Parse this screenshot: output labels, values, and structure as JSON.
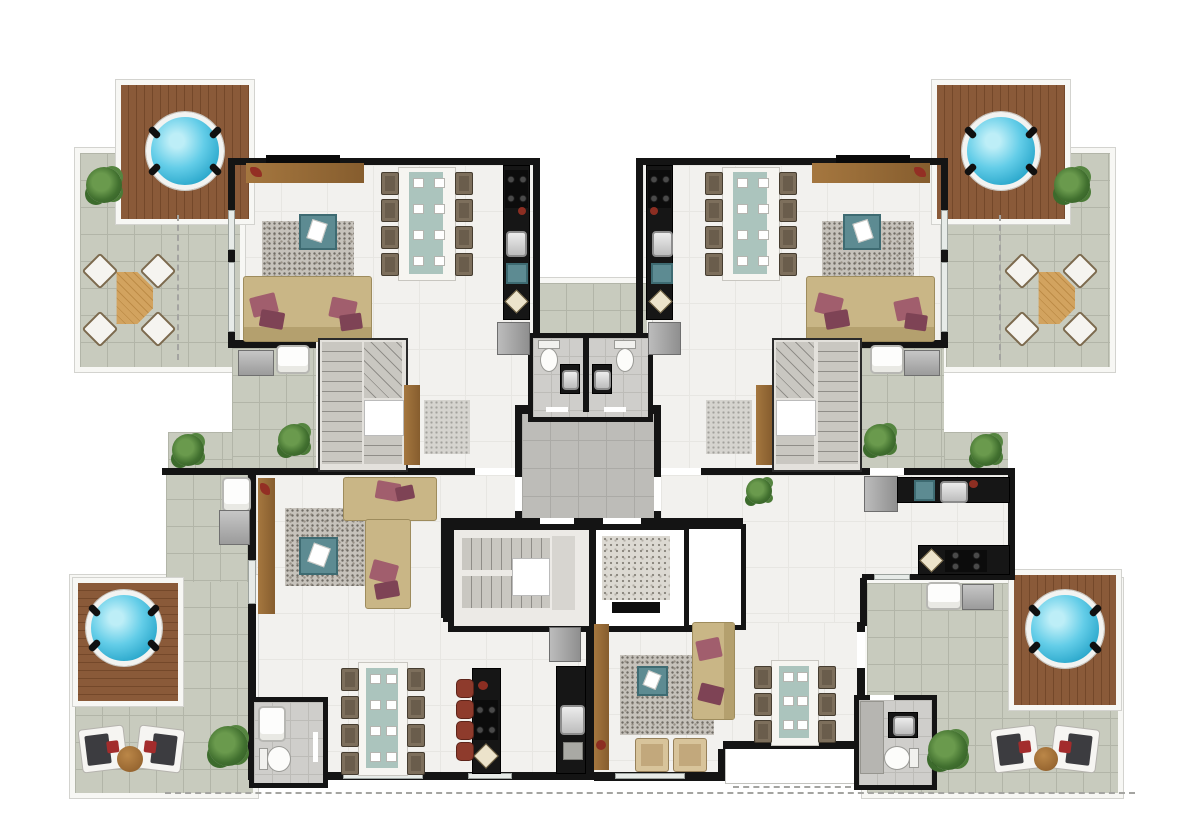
{
  "meta": {
    "title": "Penthouse floor plan – top-down architectural render",
    "plan_type": "residential multi-unit floor with roof terraces"
  },
  "colors": {
    "wall": "#141414",
    "floor": "#f2f1ee",
    "terrace": "#c8cbbe",
    "hall": "#bdbcb8",
    "deck": "#8a5a39",
    "water": "#2aa7cb",
    "counter": "#161616",
    "sofa": "#c9b686",
    "pillow": "#a15e6d",
    "teal": "#5d8b92",
    "stool": "#8e3b2c",
    "plant": "#2d5422"
  },
  "scene": {
    "units": [
      {
        "id": "top-left",
        "features": [
          "roof terrace with hot tub on wood deck",
          "octagonal outdoor table with 4 chairs",
          "living room with sofa, rug and accent table",
          "8-seat dining table",
          "galley kitchen with cooktop and sink",
          "fridge",
          "laundry terrace with washer and sink",
          "internal U-stair with wardrobe"
        ]
      },
      {
        "id": "top-right",
        "features": [
          "roof terrace with hot tub on wood deck",
          "octagonal outdoor table with 4 chairs",
          "living room with sofa, rug and accent table",
          "8-seat dining table",
          "galley kitchen with cooktop and sink",
          "fridge",
          "laundry terrace with washer and sink",
          "internal U-stair with wardrobe"
        ]
      },
      {
        "id": "bottom-left",
        "features": [
          "terrace with hot tub, 2 sun loungers and side table",
          "living room with L-sofa, rug and accent table",
          "8-seat dining table",
          "kitchen island with 4 bar stools",
          "wall counter with sink",
          "fridge",
          "bathroom with toilet and sink",
          "laundry sink and washer"
        ]
      },
      {
        "id": "bottom-right",
        "features": [
          "terrace with hot tub, 2 sun loungers and side table",
          "living room with sofa, rug, accent table and 2 armchairs",
          "6-seat dining table",
          "L-kitchen with sink and cooktop",
          "fridge",
          "bathroom with shower, toilet and sink",
          "balcony",
          "laundry sink and washer"
        ]
      }
    ],
    "core": [
      "central hallway",
      "switchback staircase",
      "elevator with stone floor",
      "two mirrored bathrooms with toilet and sink",
      "shared central terrace"
    ],
    "fixture_counts": {
      "hot_tubs": 4,
      "sun_loungers": 4,
      "octagonal_tables": 2,
      "dining_tables": 4,
      "sofas": 4,
      "armchairs": 2,
      "bar_stools": 4,
      "toilets": 4,
      "plants": 9,
      "washing_machines": 4,
      "staircases": 3,
      "elevators": 1
    },
    "annotations": [
      "dashed property line along bottom edge",
      "dashed projection lines on upper terraces"
    ]
  }
}
